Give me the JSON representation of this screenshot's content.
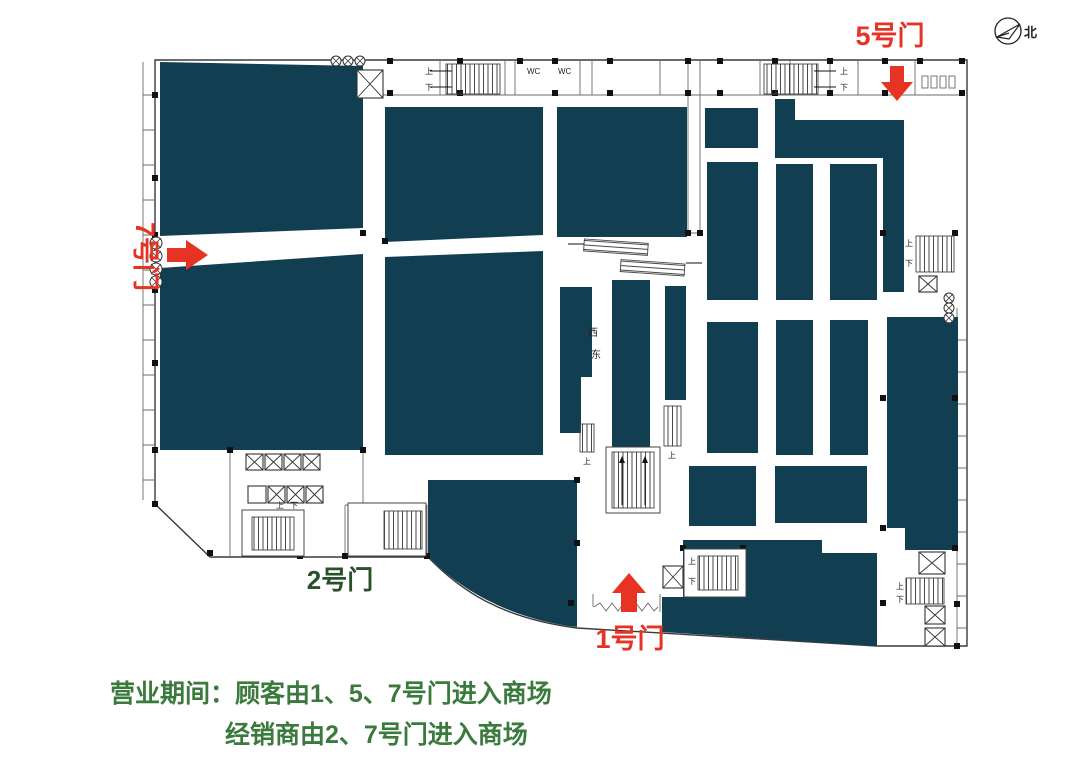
{
  "compass": {
    "north_label": "北"
  },
  "gates": {
    "gate5": {
      "label": "5号门"
    },
    "gate7": {
      "label": "7号门"
    },
    "gate1": {
      "label": "1号门"
    },
    "gate2": {
      "label": "2号门"
    }
  },
  "plan_labels": {
    "wc": "WC",
    "west": "西",
    "east": "东",
    "up": "上",
    "down": "下"
  },
  "notice": {
    "line1": "营业期间：顾客由1、5、7号门进入商场",
    "line2": "经销商由2、7号门进入商场"
  },
  "colors": {
    "block": "#113F51",
    "gate_red": "#E63323",
    "notice_green": "#3A7A3C",
    "gate2_green": "#2A512A",
    "wall": "#3A3A3A"
  }
}
